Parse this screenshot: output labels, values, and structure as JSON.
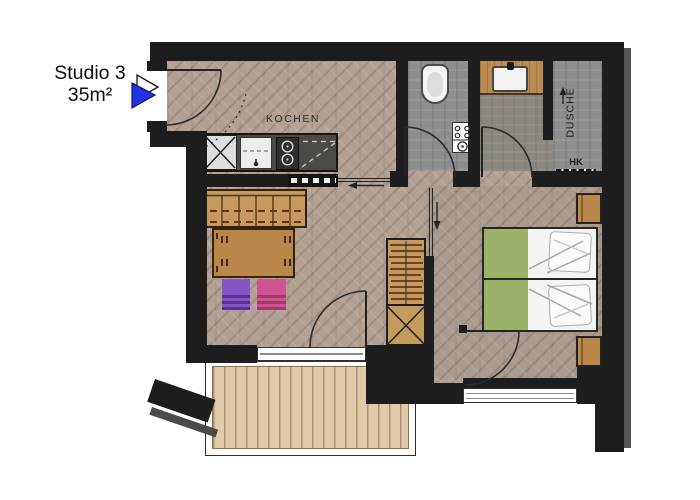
{
  "pointer": {
    "title": "Studio 3",
    "area": "35m²",
    "color": "#2133e0"
  },
  "labels": {
    "kitchen": "KOCHEN",
    "shower": "DUSCHE",
    "radiator": "HK"
  },
  "colors": {
    "wall": "#1d1d1d",
    "floor_wood": "#b2a192",
    "floor_tile": "#8e8e8e",
    "balcony_deck": "#e0caaa",
    "furniture_wood": "#c0945c",
    "kitchen_counter": "#4b4a46",
    "bed_green": "#9cb269",
    "stool_purple": "#8355c5",
    "stool_pink": "#cf5390",
    "window_frame": "#333333"
  }
}
